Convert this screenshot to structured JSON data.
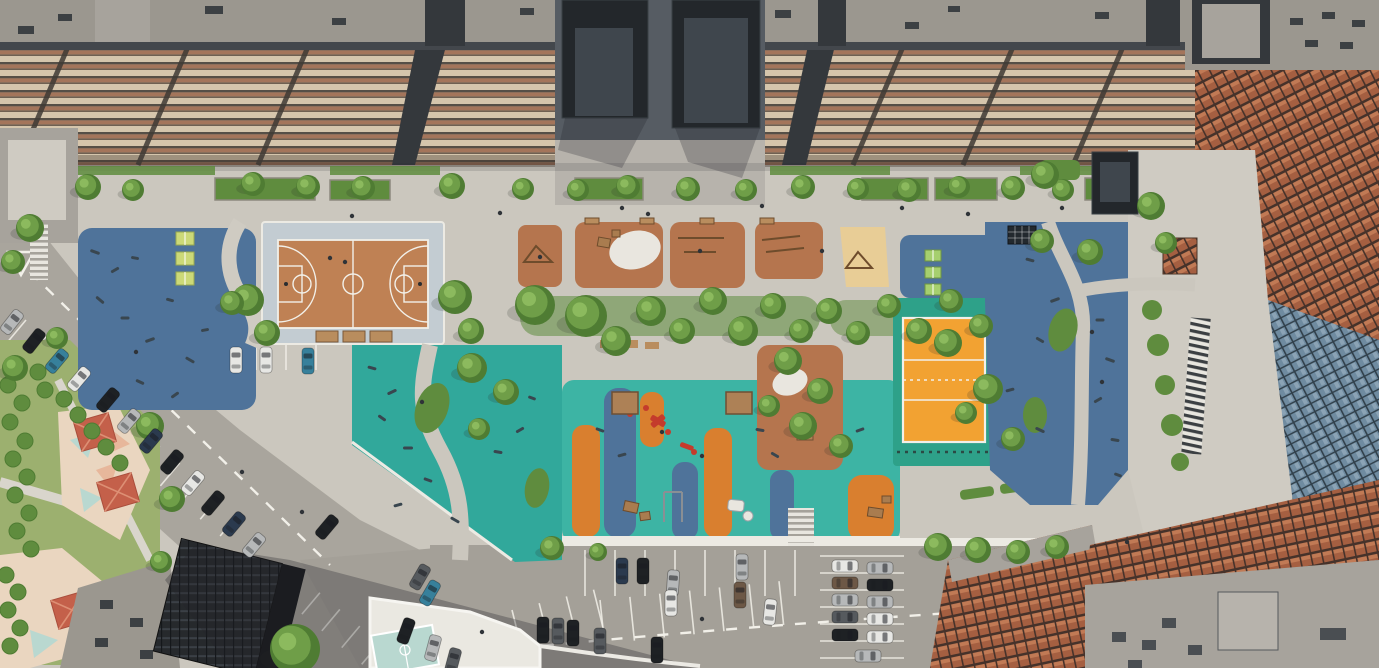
{
  "meta": {
    "description": "Aerial architectural rendering of a residential courtyard: basketball court, playgrounds with colored rubber surfacing, volleyball court, fitness zones, tree-lined promenade, kindergarten corner and parking lots between apartment blocks",
    "width": 1379,
    "height": 668
  },
  "palette": {
    "pavement": "#cbc7be",
    "promenade": "#cfcbc2",
    "plazaCobble": "#b7b3ac",
    "roadAsphalt": "#a9a59d",
    "lotAsphalt": "#a4a098",
    "roadDark": "#8f8b84",
    "curbWhite": "#eceae3",
    "lineWhite": "#f2f0e9",
    "roofGray": "#9b978f",
    "roofGray2": "#a7a39c",
    "roofDark": "#34383c",
    "roofFrame": "#43474c",
    "facadeLight": "#d5c5ac",
    "facadeBrown": "#a4755b",
    "facadeDark": "#564f47",
    "facadeShade": "#6f6052",
    "towerDark": "#23272b",
    "towerPanel": "#3f464d",
    "plazaDark": "#565c63",
    "brick": "#a55f41",
    "brickLight": "#c17a55",
    "brickDark": "#46322a",
    "glass": "#6f8ba0",
    "glassDark": "#31404b",
    "glassLight": "#8ba3b5",
    "blueRubber": "#4f739a",
    "tealRubber": "#31a89b",
    "tealBright": "#3db4a4",
    "tealCourt": "#2ea189",
    "orangeRubber": "#d97f2f",
    "volleyOrange": "#f2a232",
    "terracotta": "#b5754e",
    "courtClay": "#bf8154",
    "apron": "#c3ccd2",
    "sand": "#e8cd96",
    "tree1": "#6f9e48",
    "tree2": "#4f7c33",
    "tree3": "#8cba5e",
    "hedge": "#5f8c3e",
    "grass": "#9cb06f",
    "pingpongYellow": "#ccd978",
    "pingpongGreen": "#a6cf6e",
    "benchWood": "#b98d5e",
    "canopyWood": "#ad8156",
    "equipWood": "#a97c4f",
    "equipRed": "#c43b2c",
    "equipDark": "#39464f",
    "white": "#eae8e1",
    "blobWhite": "#e9e6df",
    "roofRed": "#c4604a",
    "roofRedLight": "#dd8f74",
    "pastel": "#ead6c0",
    "pastelBlue": "#b9d8d0",
    "pastelPink": "#e7b79b",
    "darkBuilding": "#26292c"
  },
  "carColors": {
    "white": "#e7e7e4",
    "silver": "#b6b8b9",
    "gray": "#84888b",
    "black": "#1e2124",
    "darkblue": "#2b3a4e",
    "teal": "#37809b",
    "brown": "#6d5846",
    "darkgray": "#565a5e"
  },
  "scene": {
    "trees": [
      [
        88,
        187,
        13
      ],
      [
        133,
        190,
        11
      ],
      [
        253,
        184,
        12
      ],
      [
        308,
        187,
        12
      ],
      [
        363,
        188,
        12
      ],
      [
        452,
        186,
        13
      ],
      [
        523,
        189,
        11
      ],
      [
        578,
        190,
        11
      ],
      [
        628,
        187,
        12
      ],
      [
        688,
        189,
        12
      ],
      [
        746,
        190,
        11
      ],
      [
        803,
        187,
        12
      ],
      [
        858,
        189,
        11
      ],
      [
        909,
        190,
        12
      ],
      [
        959,
        187,
        11
      ],
      [
        1013,
        188,
        12
      ],
      [
        1063,
        190,
        11
      ],
      [
        30,
        228,
        14
      ],
      [
        13,
        262,
        12
      ],
      [
        248,
        300,
        16
      ],
      [
        267,
        333,
        13
      ],
      [
        232,
        303,
        12
      ],
      [
        455,
        297,
        17
      ],
      [
        471,
        331,
        13
      ],
      [
        535,
        305,
        20
      ],
      [
        586,
        316,
        21
      ],
      [
        616,
        341,
        15
      ],
      [
        651,
        311,
        15
      ],
      [
        682,
        331,
        13
      ],
      [
        713,
        301,
        14
      ],
      [
        743,
        331,
        15
      ],
      [
        773,
        306,
        13
      ],
      [
        801,
        331,
        12
      ],
      [
        829,
        311,
        13
      ],
      [
        858,
        333,
        12
      ],
      [
        889,
        306,
        12
      ],
      [
        919,
        331,
        13
      ],
      [
        951,
        301,
        12
      ],
      [
        981,
        326,
        12
      ],
      [
        472,
        368,
        15
      ],
      [
        506,
        392,
        13
      ],
      [
        479,
        429,
        11
      ],
      [
        788,
        361,
        14
      ],
      [
        820,
        391,
        13
      ],
      [
        803,
        426,
        14
      ],
      [
        769,
        406,
        11
      ],
      [
        841,
        446,
        12
      ],
      [
        1045,
        175,
        14
      ],
      [
        1042,
        241,
        12
      ],
      [
        948,
        343,
        14
      ],
      [
        988,
        389,
        15
      ],
      [
        1013,
        439,
        12
      ],
      [
        966,
        413,
        11
      ],
      [
        1151,
        206,
        14
      ],
      [
        1166,
        243,
        11
      ],
      [
        1090,
        252,
        13
      ],
      [
        552,
        548,
        12
      ],
      [
        598,
        552,
        9
      ],
      [
        938,
        547,
        14
      ],
      [
        978,
        550,
        13
      ],
      [
        1018,
        552,
        12
      ],
      [
        1057,
        547,
        12
      ],
      [
        295,
        649,
        25
      ],
      [
        150,
        426,
        14
      ],
      [
        172,
        499,
        13
      ],
      [
        161,
        562,
        11
      ],
      [
        15,
        368,
        13
      ],
      [
        57,
        338,
        11
      ]
    ],
    "hedgeDots": [
      [
        8,
        385
      ],
      [
        22,
        403
      ],
      [
        10,
        422
      ],
      [
        25,
        441
      ],
      [
        13,
        459
      ],
      [
        27,
        477
      ],
      [
        15,
        495
      ],
      [
        29,
        513
      ],
      [
        17,
        531
      ],
      [
        31,
        549
      ],
      [
        64,
        399
      ],
      [
        78,
        415
      ],
      [
        92,
        431
      ],
      [
        106,
        447
      ],
      [
        120,
        463
      ],
      [
        6,
        575
      ],
      [
        18,
        592
      ],
      [
        8,
        610
      ],
      [
        20,
        628
      ],
      [
        10,
        646
      ],
      [
        45,
        390
      ],
      [
        38,
        372
      ]
    ],
    "cars": [
      [
        12,
        322,
        38,
        "silver"
      ],
      [
        34,
        341,
        38,
        "black"
      ],
      [
        57,
        361,
        40,
        "teal"
      ],
      [
        79,
        379,
        40,
        "white"
      ],
      [
        108,
        400,
        40,
        "black"
      ],
      [
        129,
        421,
        40,
        "silver"
      ],
      [
        151,
        441,
        40,
        "darkblue"
      ],
      [
        172,
        462,
        40,
        "black"
      ],
      [
        193,
        483,
        40,
        "white"
      ],
      [
        213,
        503,
        40,
        "black"
      ],
      [
        234,
        524,
        40,
        "darkblue"
      ],
      [
        254,
        545,
        40,
        "silver"
      ],
      [
        236,
        360,
        0,
        "white"
      ],
      [
        266,
        360,
        0,
        "white"
      ],
      [
        308,
        361,
        0,
        "teal"
      ],
      [
        327,
        527,
        40,
        "black"
      ],
      [
        420,
        577,
        30,
        "darkgray"
      ],
      [
        430,
        593,
        30,
        "teal"
      ],
      [
        406,
        631,
        20,
        "black"
      ],
      [
        433,
        648,
        15,
        "silver"
      ],
      [
        453,
        661,
        15,
        "darkgray"
      ],
      [
        543,
        630,
        0,
        "black"
      ],
      [
        558,
        631,
        0,
        "darkgray"
      ],
      [
        573,
        633,
        0,
        "black"
      ],
      [
        600,
        641,
        0,
        "darkgray"
      ],
      [
        657,
        650,
        0,
        "black"
      ],
      [
        622,
        571,
        0,
        "darkblue"
      ],
      [
        643,
        571,
        0,
        "black"
      ],
      [
        673,
        583,
        4,
        "silver"
      ],
      [
        671,
        603,
        0,
        "white"
      ],
      [
        742,
        567,
        0,
        "silver"
      ],
      [
        740,
        595,
        0,
        "brown"
      ],
      [
        770,
        612,
        6,
        "white"
      ],
      [
        845,
        566,
        90,
        "white"
      ],
      [
        845,
        583,
        90,
        "brown"
      ],
      [
        845,
        600,
        90,
        "silver"
      ],
      [
        845,
        617,
        90,
        "darkgray"
      ],
      [
        845,
        635,
        90,
        "black"
      ],
      [
        880,
        568,
        90,
        "silver"
      ],
      [
        880,
        585,
        90,
        "black"
      ],
      [
        880,
        602,
        90,
        "silver"
      ],
      [
        880,
        619,
        90,
        "white"
      ],
      [
        880,
        637,
        90,
        "white"
      ],
      [
        868,
        656,
        90,
        "silver"
      ]
    ],
    "stallRows": [
      {
        "x": 585,
        "y": 550,
        "rot": 0,
        "count": 8,
        "gap": 30,
        "len": 46,
        "dir": "v"
      },
      {
        "x": 600,
        "y": 600,
        "rot": -6,
        "count": 7,
        "gap": 30,
        "len": 44,
        "dir": "v"
      },
      {
        "x": 820,
        "y": 556,
        "rot": 0,
        "count": 7,
        "gap": 17,
        "len": 84,
        "dir": "h"
      },
      {
        "x": 26,
        "y": 320,
        "rot": 40,
        "count": 7,
        "gap": 26,
        "len": 30,
        "dir": "v"
      },
      {
        "x": 100,
        "y": 396,
        "rot": 40,
        "count": 8,
        "gap": 26,
        "len": 30,
        "dir": "v"
      },
      {
        "x": 300,
        "y": 576,
        "rot": 40,
        "count": 5,
        "gap": 26,
        "len": 28,
        "dir": "v"
      },
      {
        "x": 226,
        "y": 344,
        "rot": 0,
        "count": 4,
        "gap": 30,
        "len": 26,
        "dir": "v"
      },
      {
        "x": 512,
        "y": 610,
        "rot": -14,
        "count": 4,
        "gap": 28,
        "len": 40,
        "dir": "v"
      }
    ],
    "people": [
      [
        500,
        213
      ],
      [
        622,
        208
      ],
      [
        762,
        206
      ],
      [
        902,
        208
      ],
      [
        352,
        216
      ],
      [
        1062,
        208
      ],
      [
        540,
        257
      ],
      [
        700,
        251
      ],
      [
        822,
        251
      ],
      [
        662,
        432
      ],
      [
        702,
        456
      ],
      [
        422,
        402
      ],
      [
        1092,
        332
      ],
      [
        1102,
        382
      ],
      [
        242,
        472
      ],
      [
        302,
        512
      ],
      [
        702,
        619
      ],
      [
        482,
        632
      ],
      [
        1127,
        542
      ],
      [
        136,
        352
      ],
      [
        648,
        214
      ],
      [
        968,
        214
      ],
      [
        330,
        258
      ],
      [
        345,
        262
      ]
    ],
    "equipMarks": [
      [
        95,
        252,
        20,
        10
      ],
      [
        115,
        270,
        -30,
        9
      ],
      [
        135,
        258,
        10,
        8
      ],
      [
        100,
        300,
        40,
        10
      ],
      [
        125,
        318,
        0,
        9
      ],
      [
        150,
        340,
        -20,
        10
      ],
      [
        170,
        300,
        15,
        8
      ],
      [
        190,
        360,
        30,
        10
      ],
      [
        205,
        330,
        -10,
        8
      ],
      [
        140,
        382,
        25,
        9
      ],
      [
        175,
        395,
        -35,
        9
      ],
      [
        372,
        368,
        15,
        9
      ],
      [
        392,
        392,
        -25,
        10
      ],
      [
        382,
        418,
        35,
        9
      ],
      [
        408,
        448,
        0,
        10
      ],
      [
        428,
        480,
        20,
        9
      ],
      [
        398,
        505,
        -15,
        9
      ],
      [
        455,
        520,
        30,
        10
      ],
      [
        498,
        452,
        10,
        9
      ],
      [
        520,
        430,
        -30,
        9
      ],
      [
        532,
        398,
        20,
        8
      ],
      [
        1030,
        260,
        15,
        9
      ],
      [
        1055,
        300,
        -20,
        10
      ],
      [
        1040,
        340,
        30,
        9
      ],
      [
        1100,
        320,
        0,
        9
      ],
      [
        1110,
        360,
        20,
        10
      ],
      [
        1098,
        400,
        -30,
        9
      ],
      [
        1115,
        440,
        10,
        9
      ],
      [
        1040,
        430,
        25,
        10
      ],
      [
        1010,
        390,
        -15,
        9
      ],
      [
        1118,
        475,
        20,
        8
      ],
      [
        600,
        430,
        20,
        9
      ],
      [
        622,
        455,
        -15,
        9
      ],
      [
        760,
        430,
        10,
        9
      ],
      [
        775,
        455,
        30,
        9
      ],
      [
        860,
        430,
        -20,
        9
      ]
    ]
  }
}
